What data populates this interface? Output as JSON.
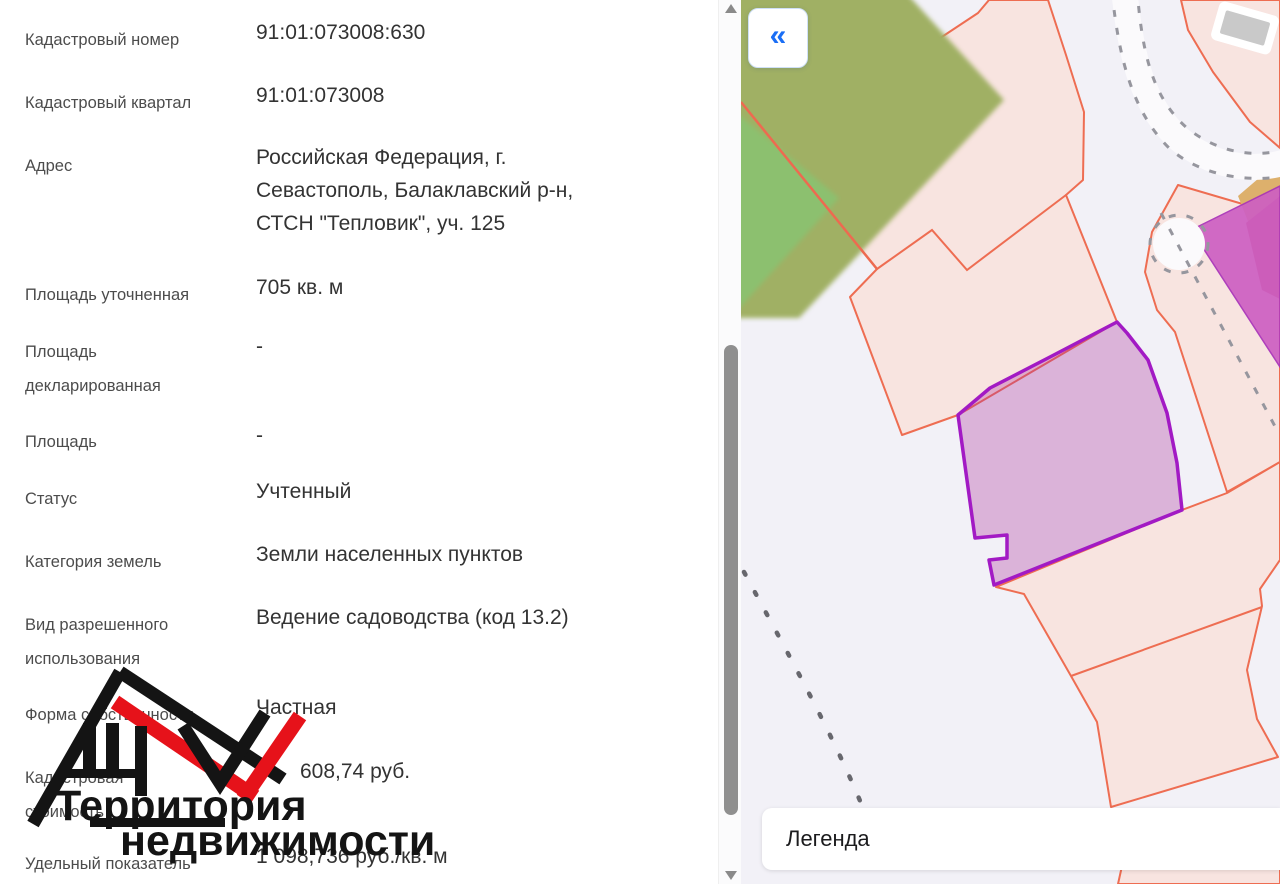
{
  "panel": {
    "rows": [
      {
        "label": "Кадастровый номер",
        "value": "91:01:073008:630"
      },
      {
        "label": "Кадастровый квартал",
        "value": "91:01:073008"
      },
      {
        "label": "Адрес",
        "value": "Российская Федерация, г. Севастополь, Балаклавский р-н, СТСН \"Тепловик\", уч. 125"
      },
      {
        "label": "Площадь уточненная",
        "value": "705 кв. м"
      },
      {
        "label": "Площадь декларированная",
        "value": "-"
      },
      {
        "label": "Площадь",
        "value": "-"
      },
      {
        "label": "Статус",
        "value": "Учтенный"
      },
      {
        "label": "Категория земель",
        "value": "Земли населенных пунктов"
      },
      {
        "label": "Вид разрешенного использования",
        "value": "Ведение садоводства (код 13.2)"
      },
      {
        "label": "Форма собственности",
        "value": "Частная"
      },
      {
        "label": "Кадастровая стоимость",
        "value": "608,74 руб."
      },
      {
        "label": "Удельный показатель",
        "value": "1 098,736 руб./кв. м"
      }
    ]
  },
  "watermark": {
    "line1": "Территория",
    "line2": "недвижимости"
  },
  "map": {
    "collapse_icon": "«",
    "legend_title": "Легенда"
  },
  "colors": {
    "parcel_stroke": "#ee6d52",
    "parcel_fill": "#f8e4e0",
    "selected_stroke": "#a21ac4",
    "selected_fill": "rgba(171,50,157,0.32)",
    "accent_blue": "#1a6ef5",
    "green_olive": "#a0b064",
    "green_bright": "#8cc06f",
    "magenta": "#cd5fc2",
    "crimson": "#c84f68",
    "tan": "#ddb06c",
    "map_background": "#f2f1f7",
    "logo_black": "#141414",
    "logo_red": "#e6121a"
  }
}
